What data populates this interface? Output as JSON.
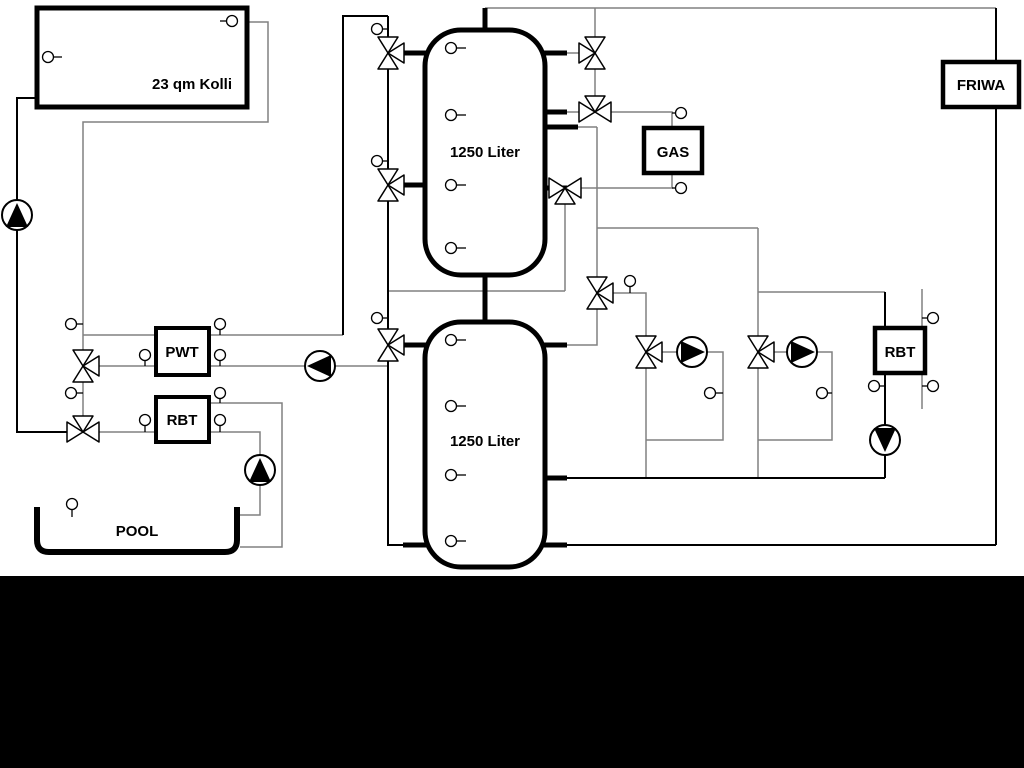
{
  "diagram": {
    "title_hint": "hydronic piping schematic",
    "labels": {
      "collector": "23 qm Kolli",
      "tank_top": "1250 Liter",
      "tank_bottom": "1250 Liter",
      "pwt": "PWT",
      "rbt_left": "RBT",
      "gas": "GAS",
      "friwa": "FRIWA",
      "rbt_right": "RBT",
      "pool": "POOL"
    },
    "colors": {
      "pipe_gray": "#808080",
      "pipe_black": "#000000",
      "equipment_outline": "#000000",
      "symbol_fill": "#ffffff",
      "background": "#ffffff",
      "footer_band": "#000000"
    }
  }
}
